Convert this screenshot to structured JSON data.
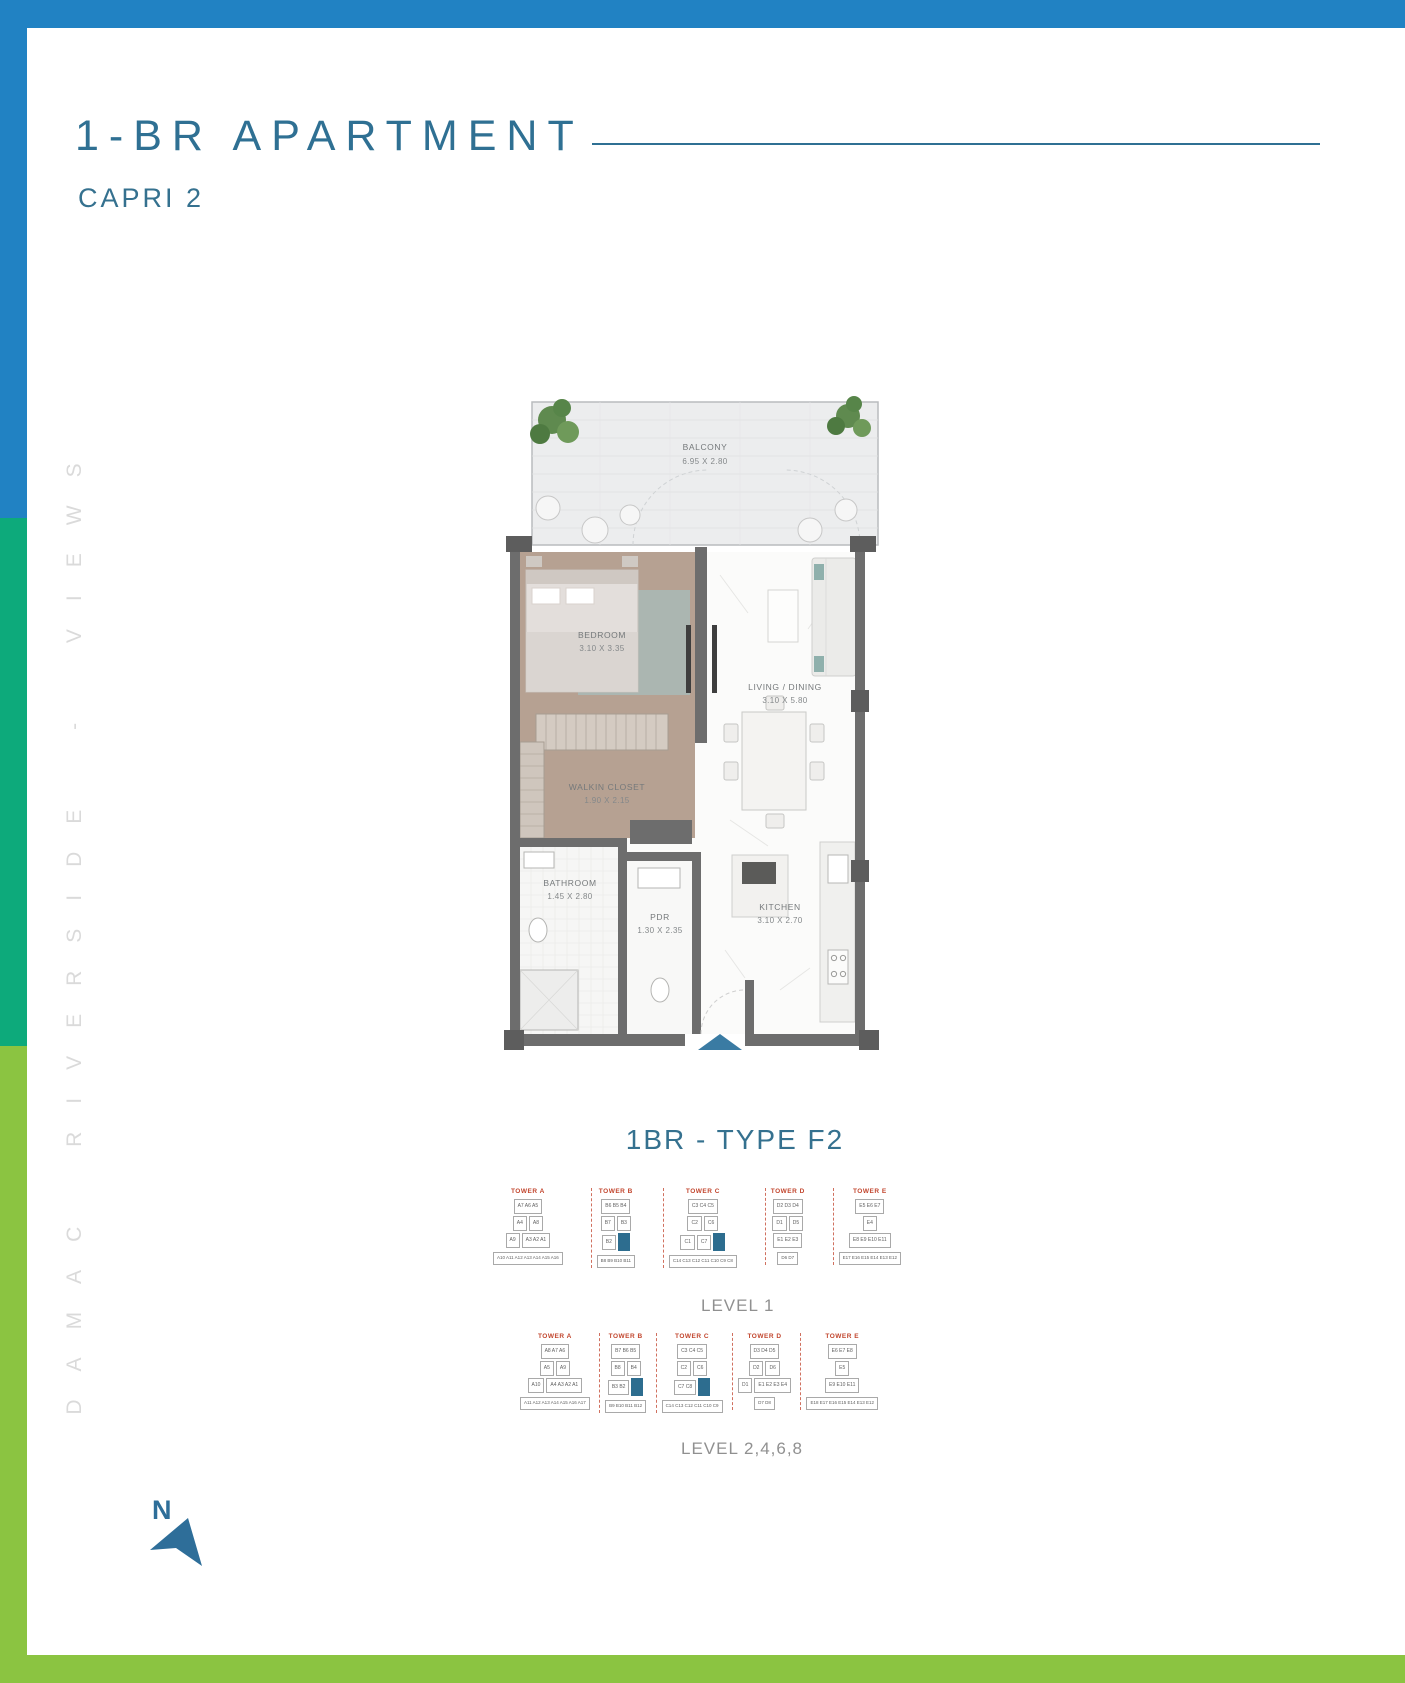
{
  "header": {
    "title": "1-BR APARTMENT",
    "subtitle": "CAPRI 2"
  },
  "side_text": "DAMAC RIVERSIDE - VIEWS",
  "plan": {
    "type_label": "1BR - TYPE F2",
    "rooms": {
      "balcony": {
        "name": "BALCONY",
        "dim": "6.95 X 2.80"
      },
      "bedroom": {
        "name": "BEDROOM",
        "dim": "3.10 X 3.35"
      },
      "living": {
        "name": "LIVING / DINING",
        "dim": "3.10 X 5.80"
      },
      "closet": {
        "name": "WALKIN CLOSET",
        "dim": "1.90 X 2.15"
      },
      "bathroom": {
        "name": "BATHROOM",
        "dim": "1.45 X 2.80"
      },
      "pdr": {
        "name": "PDR",
        "dim": "1.30 X 2.35"
      },
      "kitchen": {
        "name": "KITCHEN",
        "dim": "3.10 X 2.70"
      }
    }
  },
  "levels": {
    "level1_label": "LEVEL 1",
    "level2_label": "LEVEL 2,4,6,8"
  },
  "compass": {
    "label": "N"
  },
  "colors": {
    "accent": "#2f7093",
    "frame_blue": "#2182c3",
    "frame_teal": "#0daa7b",
    "frame_green": "#8bc441",
    "tower_label_red": "#c2462e",
    "highlight_unit": "#2d6d8f",
    "wall_gray": "#6d6d6d"
  },
  "keyplans": [
    {
      "label": "LEVEL 1",
      "towers": [
        {
          "name": "TOWER A",
          "rows": [
            [
              {
                "t": "A7 A6 A5"
              }
            ],
            [
              {
                "t": "A4"
              },
              {
                "t": "A8"
              }
            ],
            [
              {
                "t": "A9"
              },
              {
                "t": "A3 A2 A1"
              }
            ]
          ],
          "strip": "A10 A11 A12 A13 A14 A15 A16"
        },
        {
          "name": "TOWER B",
          "rows": [
            [
              {
                "t": "B6 B5 B4"
              }
            ],
            [
              {
                "t": "B7"
              },
              {
                "t": "B3"
              }
            ],
            [
              {
                "t": "B2"
              },
              {
                "hl": true
              }
            ]
          ],
          "strip": "B8 B9 B10 B11"
        },
        {
          "name": "TOWER C",
          "rows": [
            [
              {
                "t": "C3 C4 C5"
              }
            ],
            [
              {
                "t": "C2"
              },
              {
                "t": "C6"
              }
            ],
            [
              {
                "t": "C1"
              },
              {
                "t": "C7"
              },
              {
                "hl": true
              }
            ]
          ],
          "strip": "C14 C13 C12 C11 C10 C9 C8"
        },
        {
          "name": "TOWER D",
          "rows": [
            [
              {
                "t": "D2 D3 D4"
              }
            ],
            [
              {
                "t": "D1"
              },
              {
                "t": "D5"
              }
            ],
            [
              {
                "t": "E1 E2 E3"
              }
            ]
          ],
          "strip": "D6 D7"
        },
        {
          "name": "TOWER E",
          "rows": [
            [
              {
                "t": "E5 E6 E7"
              }
            ],
            [
              {
                "t": "E4"
              }
            ],
            [
              {
                "t": "E8 E9 E10 E11"
              }
            ]
          ],
          "strip": "E17 E16 E15 E14 E13 E12"
        }
      ]
    },
    {
      "label": "LEVEL 2,4,6,8",
      "towers": [
        {
          "name": "TOWER A",
          "rows": [
            [
              {
                "t": "A8 A7 A6"
              }
            ],
            [
              {
                "t": "A5"
              },
              {
                "t": "A9"
              }
            ],
            [
              {
                "t": "A10"
              },
              {
                "t": "A4 A3 A2 A1"
              }
            ]
          ],
          "strip": "A11 A12 A13 A14 A15 A16 A17"
        },
        {
          "name": "TOWER B",
          "rows": [
            [
              {
                "t": "B7 B6 B5"
              }
            ],
            [
              {
                "t": "B8"
              },
              {
                "t": "B4"
              }
            ],
            [
              {
                "t": "B3 B2"
              },
              {
                "hl": true
              }
            ]
          ],
          "strip": "B9 B10 B11 B12"
        },
        {
          "name": "TOWER C",
          "rows": [
            [
              {
                "t": "C3 C4 C5"
              }
            ],
            [
              {
                "t": "C2"
              },
              {
                "t": "C6"
              }
            ],
            [
              {
                "t": "C7 C8"
              },
              {
                "hl": true
              }
            ]
          ],
          "strip": "C14 C13 C12 C11 C10 C9"
        },
        {
          "name": "TOWER D",
          "rows": [
            [
              {
                "t": "D3 D4 D5"
              }
            ],
            [
              {
                "t": "D2"
              },
              {
                "t": "D6"
              }
            ],
            [
              {
                "t": "D1"
              },
              {
                "t": "E1 E2 E3 E4"
              }
            ]
          ],
          "strip": "D7 D8"
        },
        {
          "name": "TOWER E",
          "rows": [
            [
              {
                "t": "E6 E7 E8"
              }
            ],
            [
              {
                "t": "E5"
              }
            ],
            [
              {
                "t": "E9 E10 E11"
              }
            ]
          ],
          "strip": "E18 E17 E16 E15 E14 E13 E12"
        }
      ]
    }
  ]
}
